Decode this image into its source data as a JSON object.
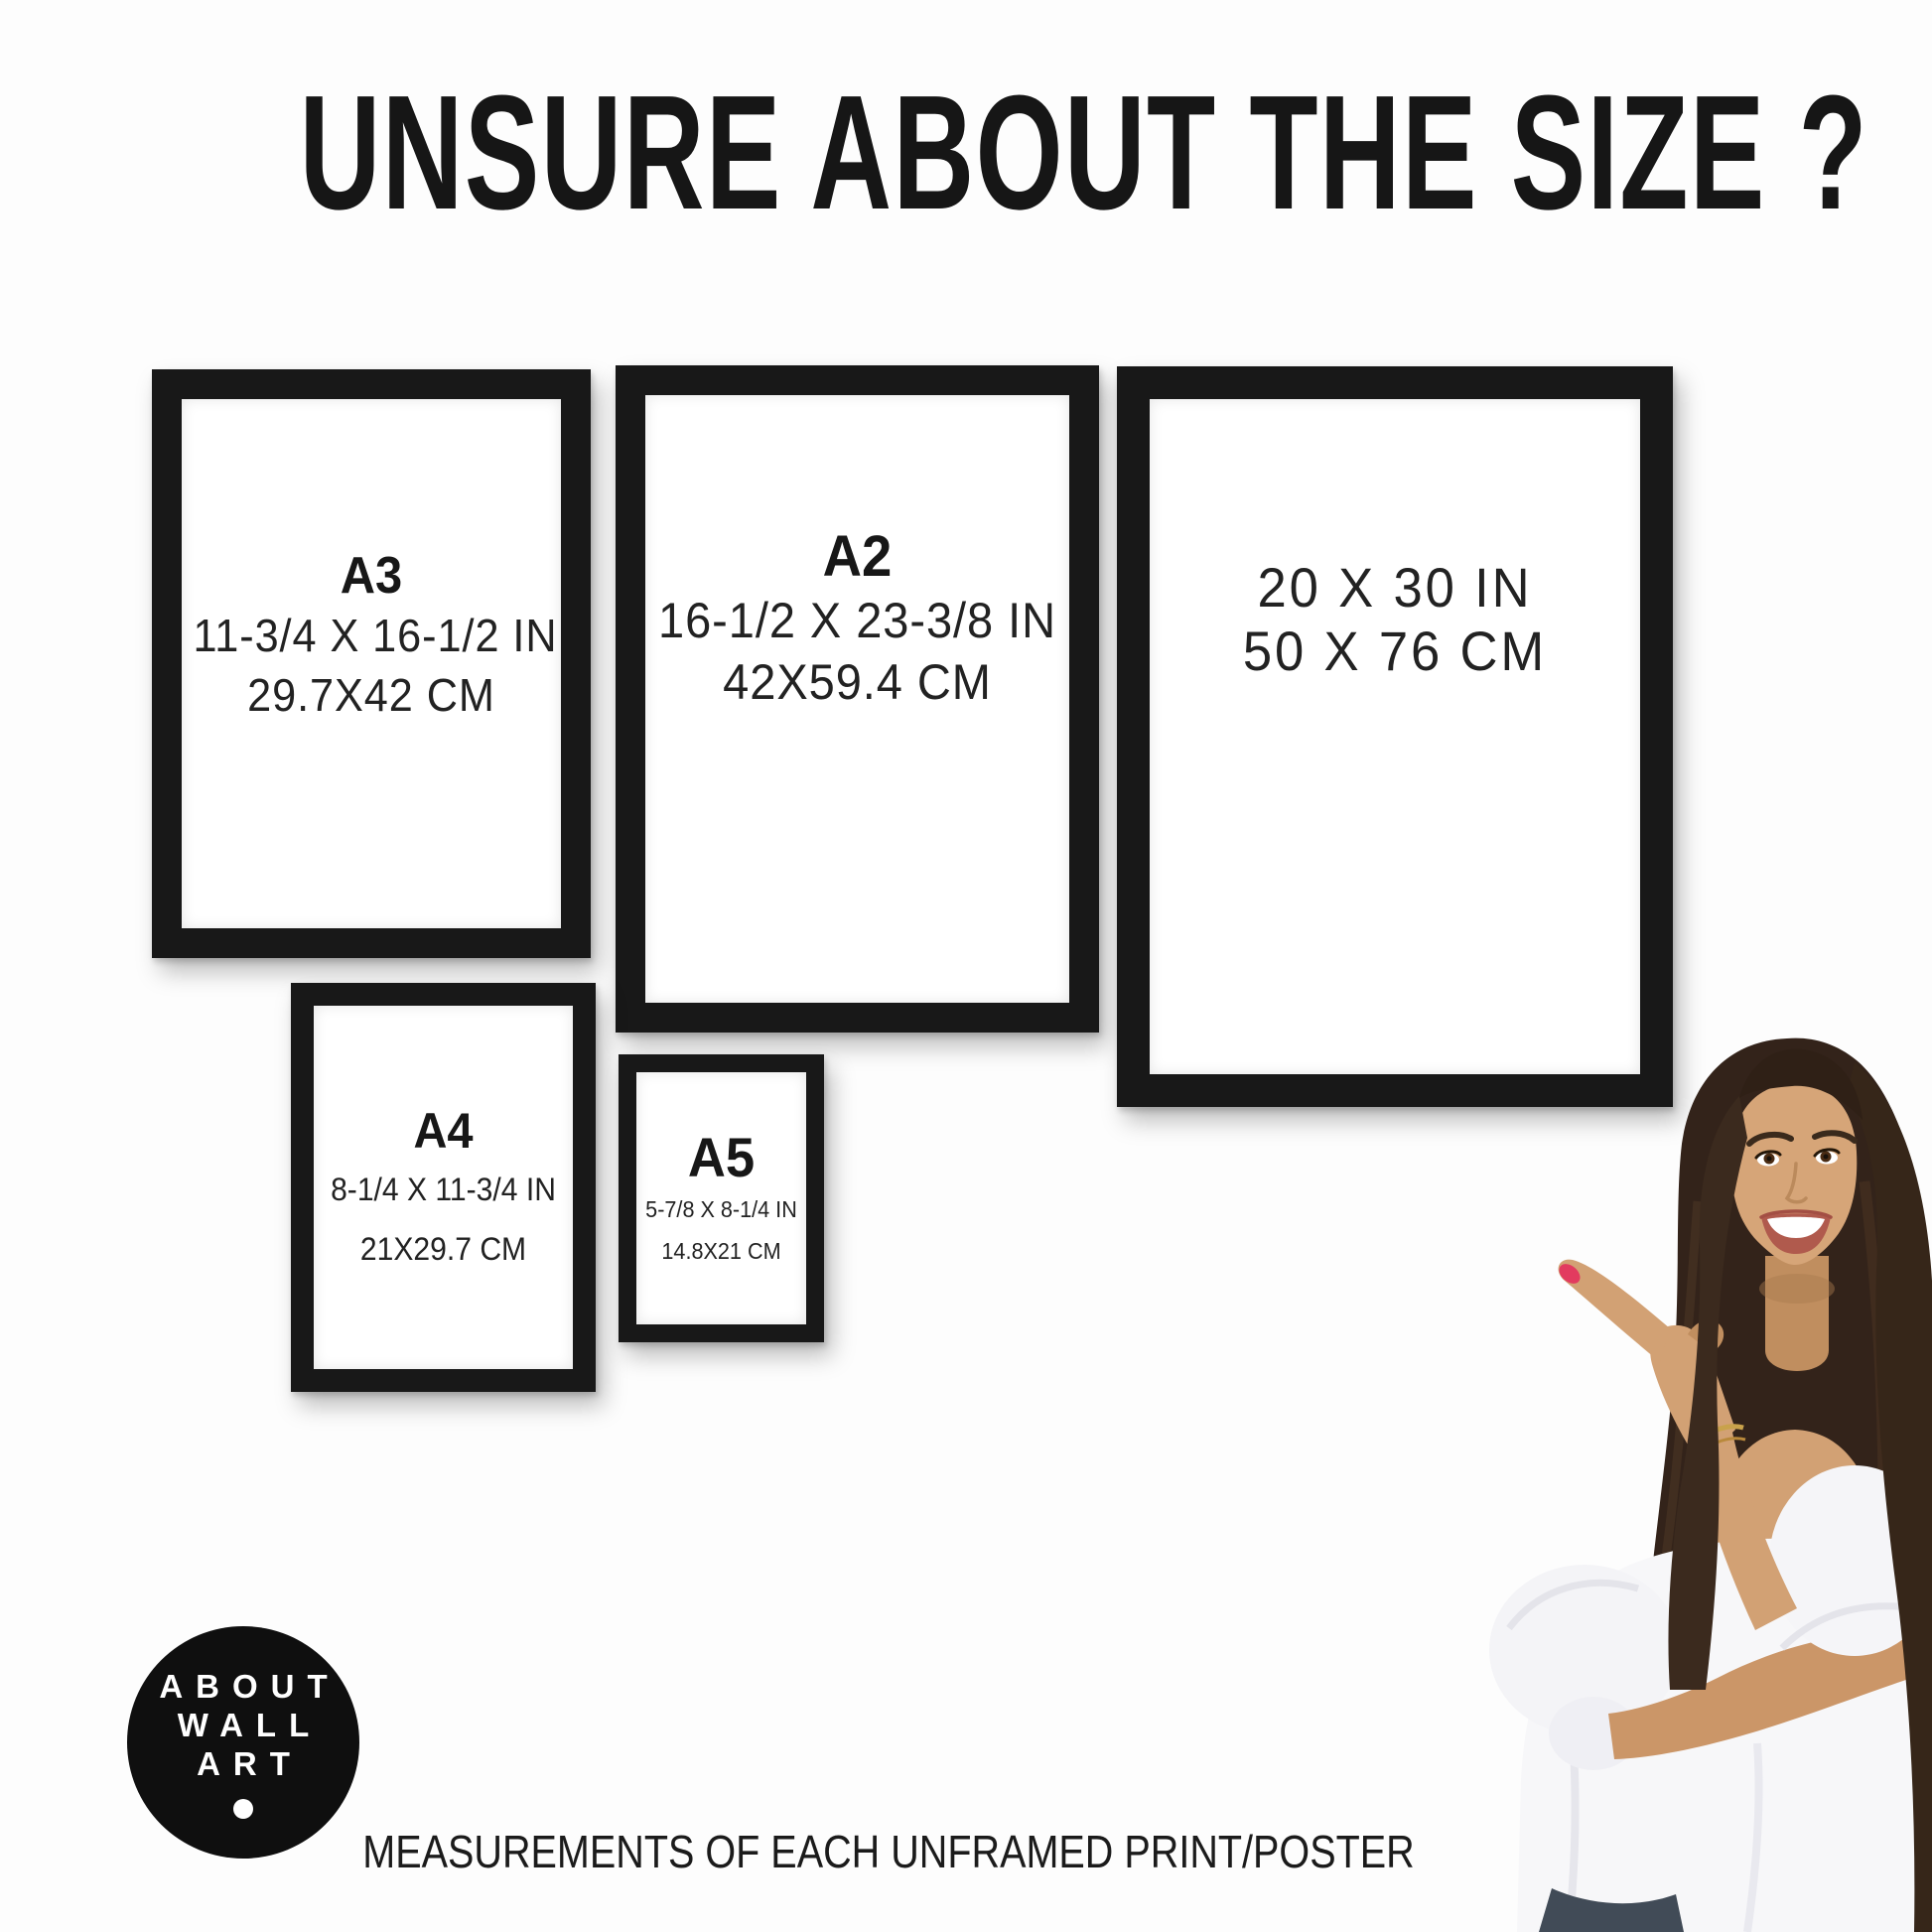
{
  "title": "UNSURE ABOUT THE SIZE ?",
  "frames": [
    {
      "label": "A3",
      "inches": "11-3/4 X 16-1/2 IN",
      "cm": "29.7X42 CM"
    },
    {
      "label": "A2",
      "inches": "16-1/2 X 23-3/8 IN",
      "cm": "42X59.4 CM"
    },
    {
      "label": "",
      "inches": "20 X 30 IN",
      "cm": "50 X 76 CM"
    },
    {
      "label": "A4",
      "inches": "8-1/4 X 11-3/4 IN",
      "cm": "21X29.7 CM"
    },
    {
      "label": "A5",
      "inches": "5-7/8 X 8-1/4 IN",
      "cm": "14.8X21 CM"
    }
  ],
  "logo": {
    "line1": "ABOUT",
    "line2": "WALL",
    "line3": "ART"
  },
  "footer": "MEASUREMENTS OF EACH UNFRAMED PRINT/POSTER",
  "colors": {
    "frame_black": "#181818",
    "background": "#fdfdfd",
    "logo_background": "#0f0f0f",
    "text": "#1d1d1d",
    "nail_red": "#e23b5f"
  }
}
